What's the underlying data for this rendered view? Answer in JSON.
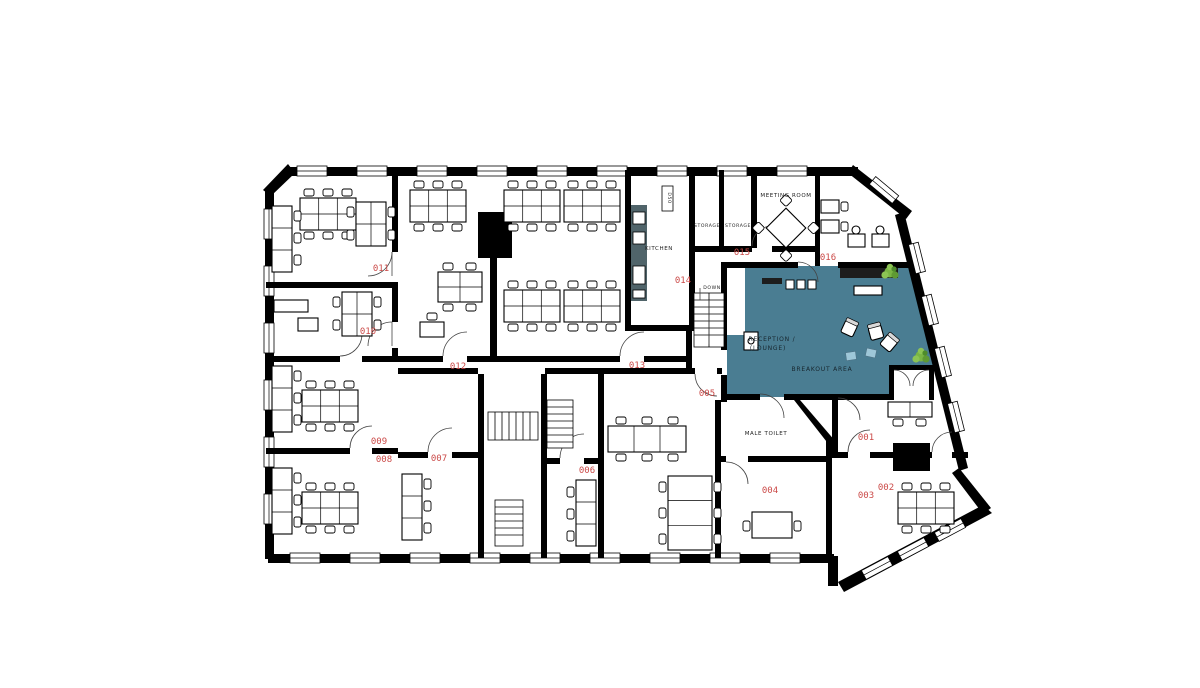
{
  "title": "Office floor plan",
  "colors": {
    "walls": "#000000",
    "highlight_area": "#4a7d92",
    "room_number_red": "#cb4a48",
    "kitchen_counter": "#50646a",
    "plant_green": "#79b544"
  },
  "rooms": [
    {
      "number": "001"
    },
    {
      "number": "002"
    },
    {
      "number": "003"
    },
    {
      "number": "004"
    },
    {
      "number": "005"
    },
    {
      "number": "006"
    },
    {
      "number": "007"
    },
    {
      "number": "008"
    },
    {
      "number": "009"
    },
    {
      "number": "010"
    },
    {
      "number": "011"
    },
    {
      "number": "012"
    },
    {
      "number": "013"
    },
    {
      "number": "014"
    },
    {
      "number": "015"
    },
    {
      "number": "016"
    }
  ],
  "areas": {
    "kitchen": "KITCHEN",
    "storage1": "STORAGE",
    "storage2": "STORAGE",
    "meeting_room": "MEETING ROOM",
    "male_toilet": "MALE TOILET",
    "stairs_down": "DOWN",
    "reception_line1": "RECEPTION /",
    "reception_line2": "(LOUNGE)",
    "breakout": "BREAKOUT AREA",
    "door_tag": "D50"
  }
}
